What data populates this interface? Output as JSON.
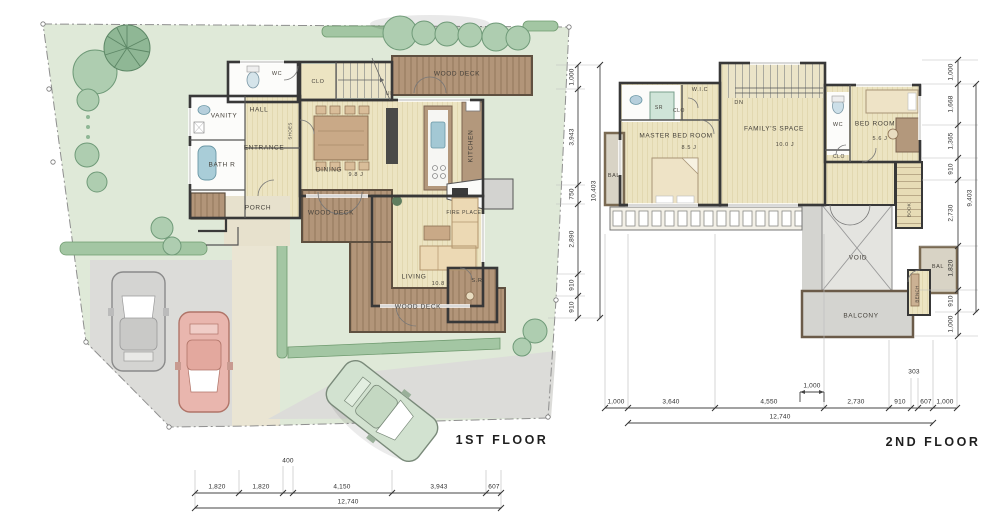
{
  "drawing": {
    "first_floor": {
      "title": "1ST  FLOOR",
      "rooms": {
        "wc": "WC",
        "clo": "CLO",
        "wood_deck_top": "WOOD DECK",
        "hall": "HALL",
        "vanity": "VANITY",
        "bath": "BATH R",
        "entrance": "ENTRANCE",
        "shoes": "SHOES",
        "porch": "PORCH",
        "dining": "DINING",
        "dining_size": "9.8 J",
        "kitchen": "KITCHEN",
        "fire_place": "FIRE PLACE",
        "up": "UP",
        "wood_deck_mid": "WOOD DECK",
        "living": "LIVING",
        "living_size": "10.8 J",
        "study": "S.R",
        "wood_deck_bottom": "WOOD DECK"
      },
      "dims_right": [
        "1,000",
        "3,943",
        "750",
        "2,890",
        "910",
        "910"
      ],
      "dims_right_total": "10,403",
      "dims_bottom": [
        "1,820",
        "1,820",
        "400",
        "4,150",
        "3,943",
        "607"
      ],
      "dims_bottom_total": "12,740"
    },
    "second_floor": {
      "title": "2ND  FLOOR",
      "rooms": {
        "shower": "SR",
        "clo_left": "CLO",
        "wic": "W.I.C",
        "dn": "DN",
        "master": "MASTER BED ROOM",
        "master_size": "8.5 J",
        "family": "FAMILY'S SPACE",
        "family_size": "10.0 J",
        "wc": "WC",
        "clo_right": "CLO",
        "bedroom": "BED ROOM",
        "bedroom_size": "5.6 J",
        "bal_left": "BAL",
        "book": "BOOK",
        "void": "VOID",
        "bal_right": "BAL",
        "bench": "BENCH",
        "balcony": "BALCONY"
      },
      "dims_right": [
        "1,000",
        "1,668",
        "1,365",
        "910",
        "2,730",
        "1,820",
        "910",
        "1,000"
      ],
      "dims_right_total": "9,403",
      "dims_bottom": [
        "1,000",
        "3,640",
        "4,550",
        "2,730",
        "910",
        "303",
        "607",
        "1,000"
      ],
      "dims_bottom_sub": "1,000",
      "dims_bottom_total": "12,740"
    },
    "colors": {
      "site_green": "#dfe9d8",
      "floor_cream": "#ece4c2",
      "deck_brown": "#b29579",
      "wall_dark": "#383838",
      "paving_gray": "#dcdcd9",
      "tree_green": "#aecdb0",
      "car_gray": "#d4d4d2",
      "car_pink": "#e9b6ae",
      "car_green": "#d2e2d0"
    }
  }
}
